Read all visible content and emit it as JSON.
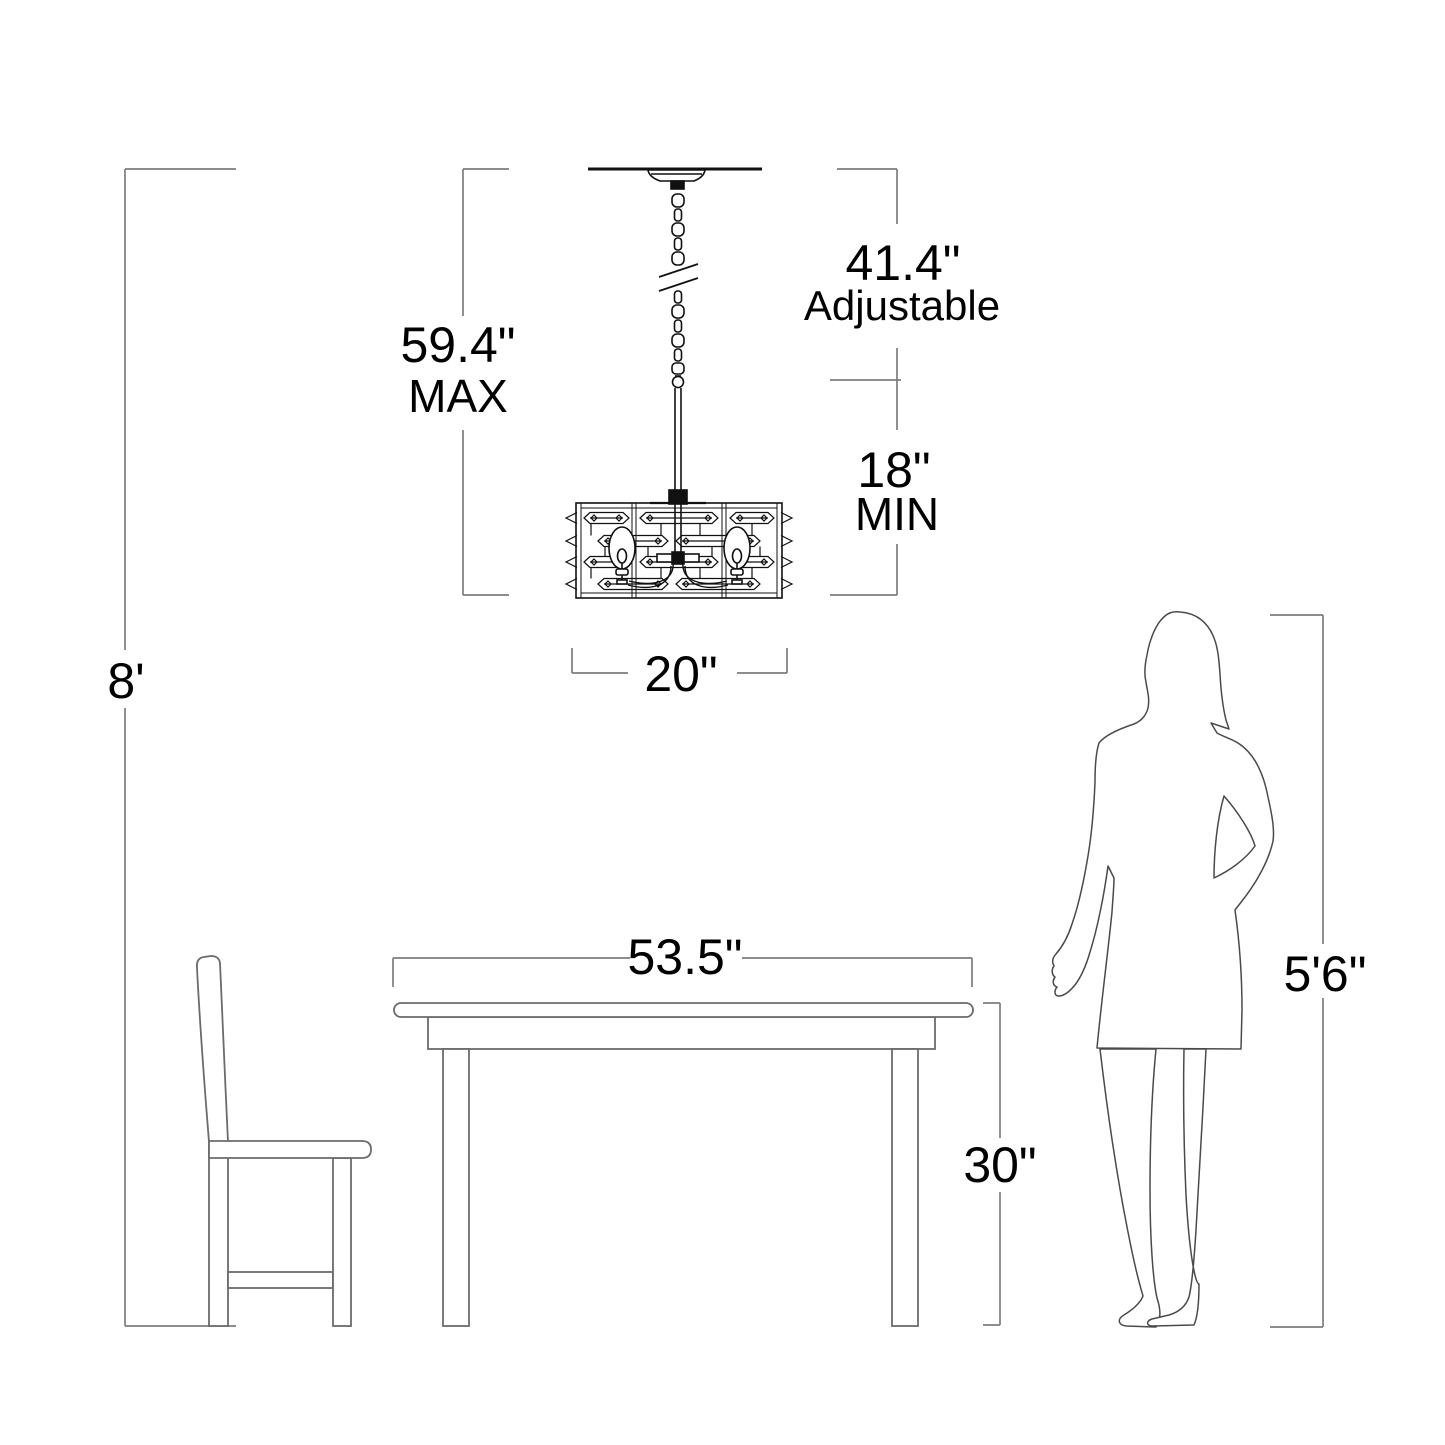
{
  "diagram": {
    "title": "Chandelier mounting dimension diagram",
    "colors": {
      "dimension_line": "#7d7d7d",
      "furniture_line": "#6b6b6b",
      "fixture_line": "#111111",
      "text": "#000000",
      "background": "#ffffff"
    },
    "labels": {
      "ceiling_height": "8'",
      "max_drop_value": "59.4\"",
      "max_drop_word": "MAX",
      "adjustable_value": "41.4\"",
      "adjustable_word": "Adjustable",
      "min_drop_value": "18\"",
      "min_drop_word": "MIN",
      "fixture_width": "20\"",
      "table_width": "53.5\"",
      "table_height": "30\"",
      "person_height": "5'6\""
    }
  }
}
